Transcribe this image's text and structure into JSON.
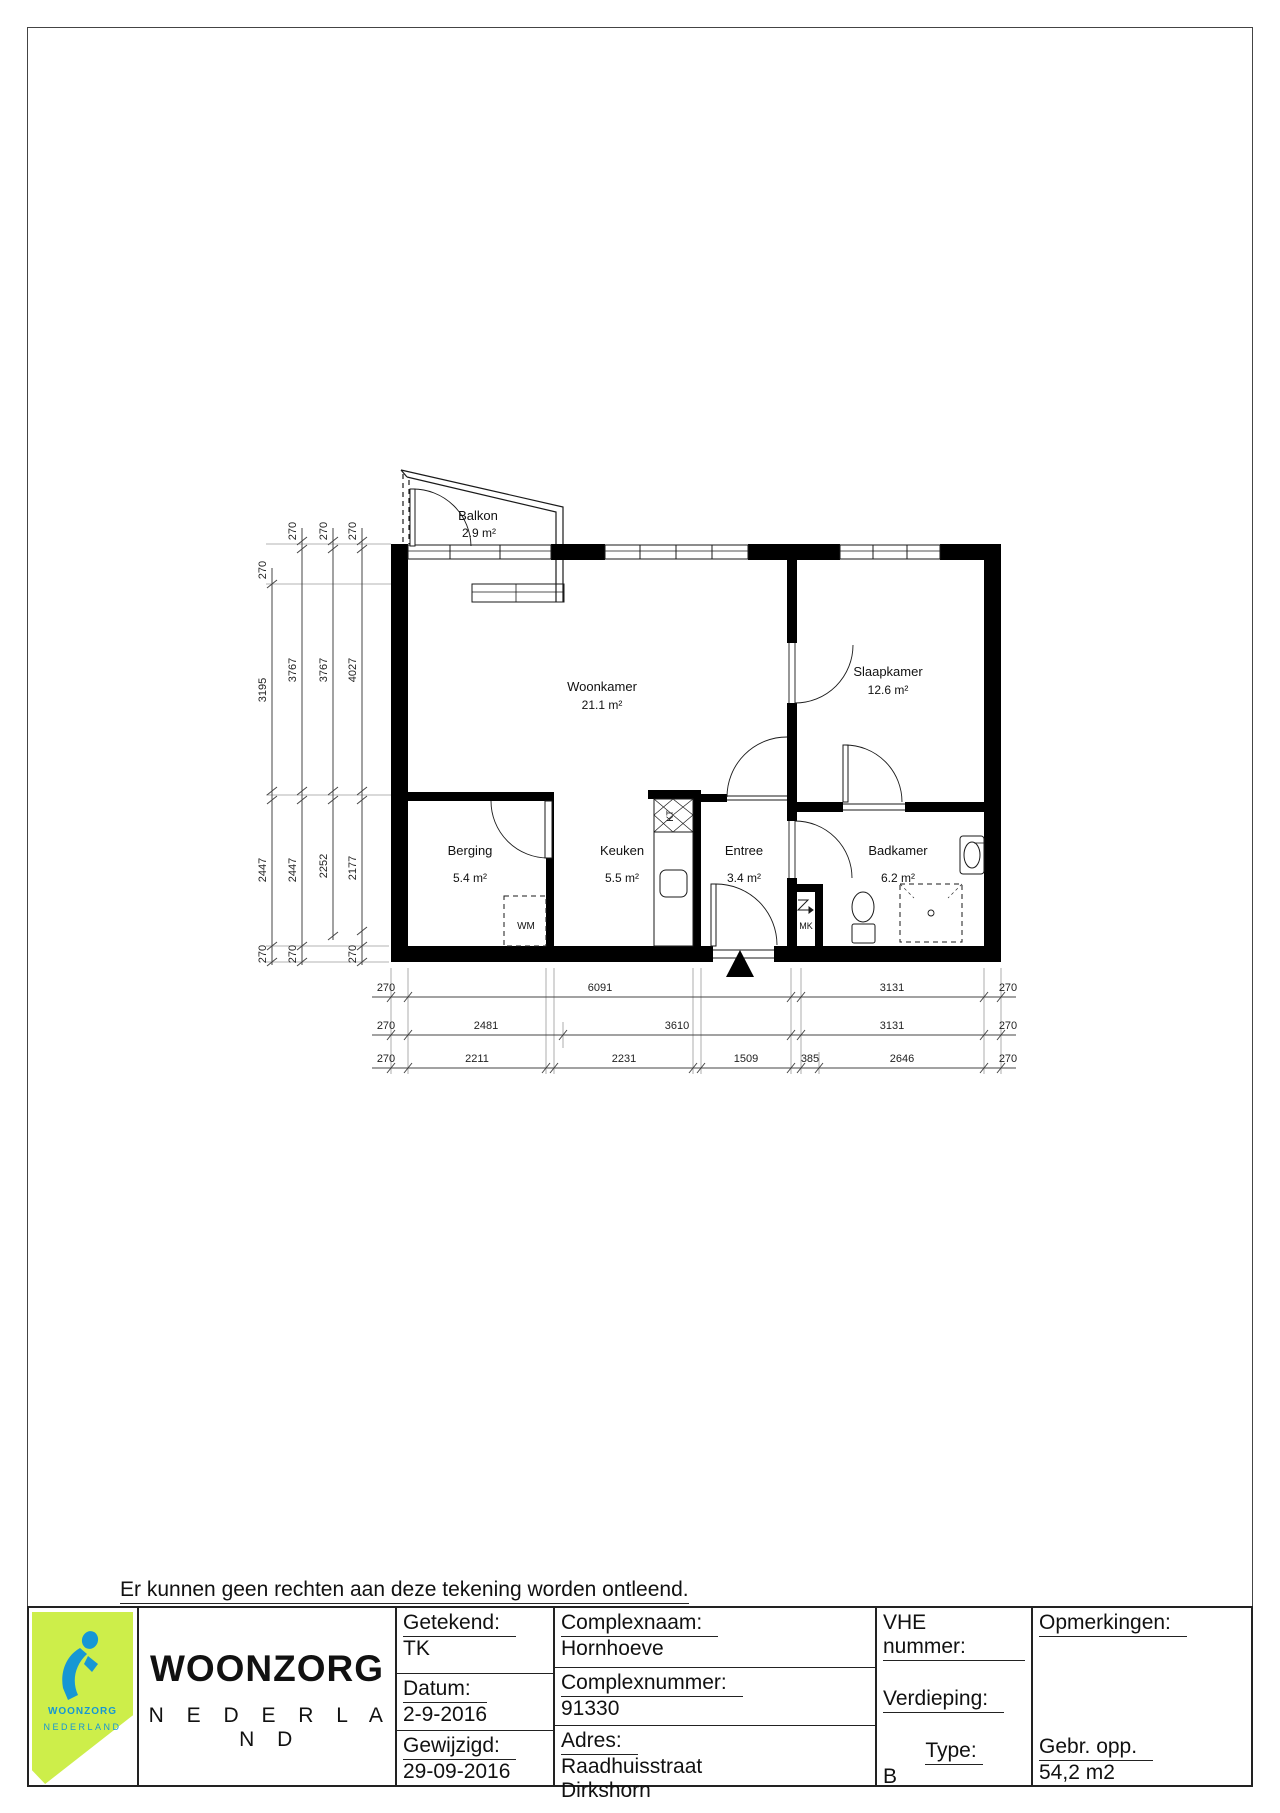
{
  "disclaimer": "Er kunnen geen rechten aan deze tekening worden ontleend.",
  "plan": {
    "rooms": {
      "balkon": {
        "name": "Balkon",
        "area": "2.9 m²"
      },
      "woonkamer": {
        "name": "Woonkamer",
        "area": "21.1 m²"
      },
      "slaapkamer": {
        "name": "Slaapkamer",
        "area": "12.6 m²"
      },
      "berging": {
        "name": "Berging",
        "area": "5.4 m²"
      },
      "keuken": {
        "name": "Keuken",
        "area": "5.5 m²"
      },
      "entree": {
        "name": "Entree",
        "area": "3.4 m²"
      },
      "badkamer": {
        "name": "Badkamer",
        "area": "6.2 m²"
      }
    },
    "labels": {
      "wm": "WM",
      "kt": "KT",
      "mk": "MK"
    },
    "dims": {
      "left": {
        "c1": [
          "270",
          "3195",
          "2447",
          "270"
        ],
        "c2": [
          "270",
          "3767",
          "2447",
          "270"
        ],
        "c3": [
          "270",
          "3767",
          "2252"
        ],
        "c4": [
          "270",
          "4027",
          "2177",
          "270"
        ]
      },
      "bottom": {
        "r1": [
          "270",
          "6091",
          "3131",
          "270"
        ],
        "r2": [
          "270",
          "2481",
          "3610",
          "3131",
          "270"
        ],
        "r3": [
          "270",
          "2211",
          "2231",
          "1509",
          "385",
          "2646",
          "270"
        ]
      }
    }
  },
  "titleblock": {
    "brand": {
      "line1": "WOONZORG",
      "line2": "N E D E R L A N D",
      "logo_line1": "WOONZORG",
      "logo_line2": "NEDERLAND"
    },
    "fields": {
      "getekend_label": "Getekend:",
      "getekend": "TK",
      "datum_label": "Datum:",
      "datum": "2-9-2016",
      "gewijzigd_label": "Gewijzigd:",
      "gewijzigd": "29-09-2016",
      "complexnaam_label": "Complexnaam:",
      "complexnaam": "Hornhoeve",
      "complexnummer_label": "Complexnummer:",
      "complexnummer": "91330",
      "adres_label": "Adres:",
      "adres_1": "Raadhuisstraat",
      "adres_2": "Dirkshorn",
      "vhe_label": "VHE nummer:",
      "verdieping_label": "Verdieping:",
      "type_label": "Type:",
      "type": "B",
      "opmerkingen_label": "Opmerkingen:",
      "gebropp_label": "Gebr. opp.",
      "gebropp": "54,2 m2"
    }
  },
  "colors": {
    "accent_lime": "#cdee4a",
    "accent_blue": "#1697d4"
  }
}
